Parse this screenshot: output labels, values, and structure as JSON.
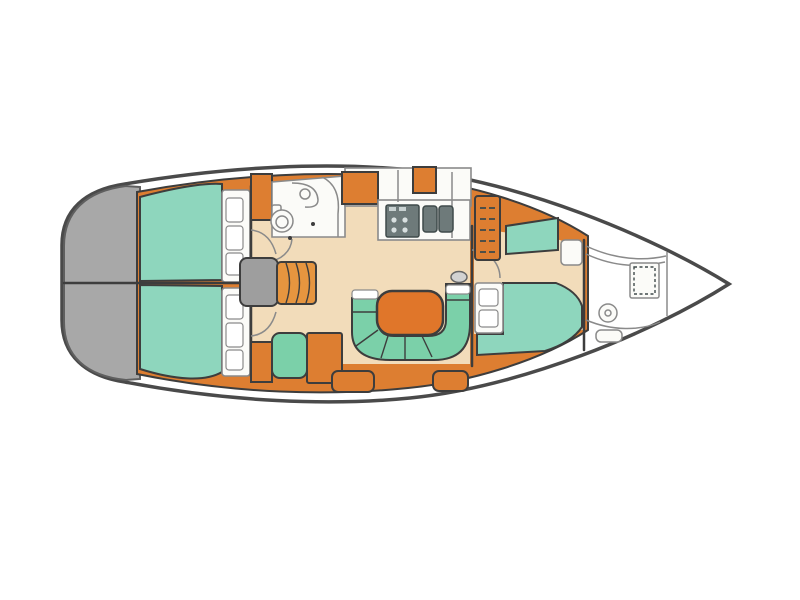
{
  "diagram": {
    "type": "sailboat-interior-floor-plan",
    "orientation": "bow-right-stern-left",
    "visible_text": ""
  },
  "colors": {
    "hull_outline": "#4a4a4a",
    "transom_gray": "#a8a8a8",
    "transom_edge": "#5f5f5f",
    "furniture_orange": "#dd7e31",
    "furniture_outline": "#3d3d3d",
    "step_orange": "#e6953f",
    "table_orange": "#e0762a",
    "floor_cream": "#f2dcba",
    "bed_teal": "#8ed6bd",
    "settee_teal": "#7bd0a9",
    "fixture_white": "#fbfbf8",
    "fixture_outline": "#8a8a8a",
    "appliance_gray": "#6e7a7a",
    "appliance_dark": "#3f4a4a",
    "companionway_gray": "#9e9e9e"
  },
  "regions": [
    "swim-platform",
    "aft-cabin-port",
    "aft-cabin-starboard",
    "head-compartment",
    "galley",
    "companionway",
    "salon-dinette",
    "nav-station",
    "forward-cabin",
    "anchor-locker"
  ]
}
